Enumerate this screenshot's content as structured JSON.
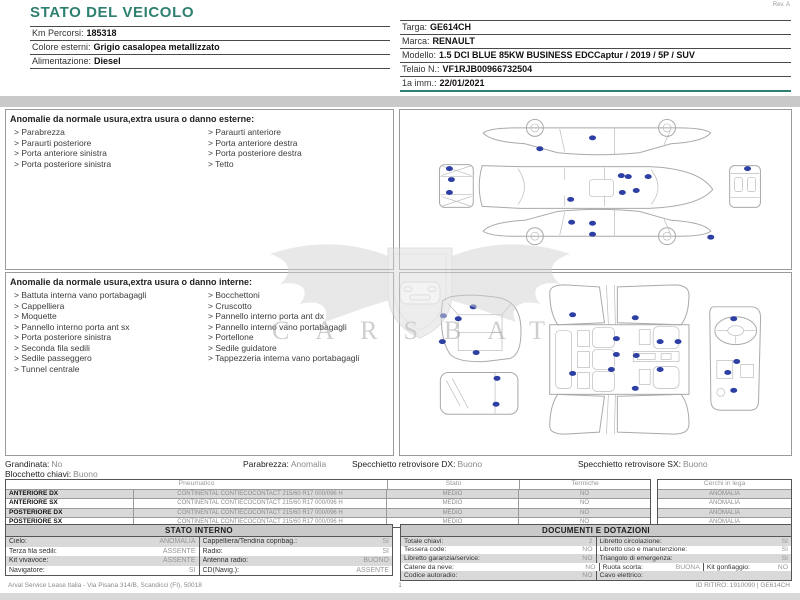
{
  "page": {
    "title": "STATO DEL VEICOLO",
    "rev": "Rev. A"
  },
  "colors": {
    "accent_teal": "#2e8070",
    "dot_blue": "#2e3fa3",
    "band_gray": "#c9c9c9"
  },
  "vehicle_info": {
    "left": [
      {
        "label": "Km Percorsi:",
        "value": "185318"
      },
      {
        "label": "Colore esterni:",
        "value": "Grigio casalopea metallizzato"
      },
      {
        "label": "Alimentazione:",
        "value": "Diesel"
      }
    ],
    "right": [
      {
        "label": "Targa:",
        "value": "GE614CH"
      },
      {
        "label": "Marca:",
        "value": "RENAULT"
      },
      {
        "label": "Modello:",
        "value": "1.5 DCI BLUE 85KW BUSINESS EDCCaptur / 2019 / 5P / SUV"
      },
      {
        "label": "Telaio N.:",
        "value": "VF1RJB00966732504"
      },
      {
        "label": "1a imm.:",
        "value": "22/01/2021"
      }
    ]
  },
  "anomalies_exterior": {
    "title": "Anomalie da normale usura,extra usura o danno esterne:",
    "left": [
      "> Parabrezza",
      "> Paraurti posteriore",
      "> Porta anteriore sinistra",
      "> Porta posteriore sinistra"
    ],
    "right": [
      "> Paraurti anteriore",
      "> Porta anteriore destra",
      "> Porta posteriore destra",
      "> Tetto"
    ]
  },
  "anomalies_interior": {
    "title": "Anomalie da normale usura,extra usura o danno interne:",
    "left": [
      "> Battuta interna vano portabagagli",
      "> Cappelliera",
      "> Moquette",
      "> Pannello interno porta ant sx",
      "> Porta posteriore sinistra",
      "> Seconda fila sedili",
      "> Sedile passeggero",
      "> Tunnel centrale"
    ],
    "right": [
      "> Bocchettoni",
      "> Cruscotto",
      "> Pannello interno porta ant dx",
      "> Pannello interno vano portabagagli",
      "> Portellone",
      "> Sedile guidatore",
      "> Tappezzeria interna vano portabagagli"
    ]
  },
  "condition_summary": {
    "grandinata": {
      "label": "Grandinata:",
      "value": "No"
    },
    "parabrezza": {
      "label": "Parabrezza:",
      "value": "Anomalia"
    },
    "specchietto_dx": {
      "label": "Specchietto retrovisore DX:",
      "value": "Buono"
    },
    "specchietto_sx": {
      "label": "Specchietto retrovisore SX:",
      "value": "Buono"
    },
    "blocchetto": {
      "label": "Blocchetto chiavi:",
      "value": "Buono"
    }
  },
  "tires": {
    "headers": {
      "pneumatico": "Pneumatico",
      "stato": "Stato",
      "termiche": "Termiche",
      "cerchi": "Cerchi in lega"
    },
    "rows": [
      {
        "pos": "ANTERIORE DX",
        "pneumatico": "CONTINENTAL CONTIECOCONTACT 215/60 R17 000/096 H",
        "stato": "MEDIO",
        "termiche": "NO",
        "cerchi": "ANOMALIA"
      },
      {
        "pos": "ANTERIORE SX",
        "pneumatico": "CONTINENTAL CONTIECOCONTACT 215/60 R17 000/096 H",
        "stato": "MEDIO",
        "termiche": "NO",
        "cerchi": "ANOMALIA"
      },
      {
        "pos": "POSTERIORE DX",
        "pneumatico": "CONTINENTAL CONTIECOCONTACT 215/60 R17 000/096 H",
        "stato": "MEDIO",
        "termiche": "NO",
        "cerchi": "ANOMALIA"
      },
      {
        "pos": "POSTERIORE SX",
        "pneumatico": "CONTINENTAL CONTIECOCONTACT 215/60 R17 000/096 H",
        "stato": "MEDIO",
        "termiche": "NO",
        "cerchi": "ANOMALIA"
      }
    ]
  },
  "stato_interno": {
    "title": "STATO INTERNO",
    "rows": [
      {
        "l1": "Cielo:",
        "v1": "ANOMALIA",
        "l2": "Cappelliera/Tendina copribag.:",
        "v2": "SI"
      },
      {
        "l1": "Terza fila sedili:",
        "v1": "ASSENTE",
        "l2": "Radio:",
        "v2": "SI"
      },
      {
        "l1": "Kit vivavoce:",
        "v1": "ASSENTE",
        "l2": "Antenna radio:",
        "v2": "BUONO"
      },
      {
        "l1": "Navigatore:",
        "v1": "SI",
        "l2": "CD(Navig.):",
        "v2": "ASSENTE"
      }
    ]
  },
  "documenti": {
    "title": "DOCUMENTI E DOTAZIONI",
    "rows": [
      {
        "l1": "Totale chiavi:",
        "v1": "2",
        "l2": "Libretto circolazione:",
        "v2": "SI"
      },
      {
        "l1": "Tessera code:",
        "v1": "NO",
        "l2": "Libretto uso e manutenzione:",
        "v2": "SI"
      },
      {
        "l1": "Libretto garanzia/service:",
        "v1": "NO",
        "l2": "Triangolo di emergenza:",
        "v2": "SI"
      },
      {
        "l1": "Catene da neve:",
        "v1": "NO",
        "l2": "Ruota scorta:",
        "v2": "BUONA",
        "l3": "Kit gonfiaggio:",
        "v3": "NO"
      },
      {
        "l1": "Codice autoradio:",
        "v1": "NO",
        "l2": "Cavo elettrico:",
        "v2": ""
      }
    ]
  },
  "watermark": {
    "letters": "CARSBAT"
  },
  "diagrams": {
    "exterior_dots": [
      [
        193,
        28
      ],
      [
        140,
        39
      ],
      [
        222,
        66
      ],
      [
        229,
        67
      ],
      [
        249,
        67
      ],
      [
        237,
        81
      ],
      [
        223,
        83
      ],
      [
        171,
        90
      ],
      [
        49,
        59
      ],
      [
        51,
        70
      ],
      [
        49,
        83
      ],
      [
        349,
        59
      ],
      [
        172,
        113
      ],
      [
        193,
        114
      ],
      [
        193,
        125
      ],
      [
        312,
        128
      ]
    ],
    "interior_dots": [
      [
        73,
        34
      ],
      [
        43,
        43
      ],
      [
        58,
        46
      ],
      [
        42,
        69
      ],
      [
        76,
        80
      ],
      [
        97,
        106
      ],
      [
        96,
        132
      ],
      [
        173,
        42
      ],
      [
        236,
        45
      ],
      [
        217,
        66
      ],
      [
        261,
        69
      ],
      [
        279,
        69
      ],
      [
        217,
        82
      ],
      [
        237,
        83
      ],
      [
        212,
        97
      ],
      [
        261,
        97
      ],
      [
        173,
        101
      ],
      [
        236,
        116
      ],
      [
        335,
        46
      ],
      [
        338,
        89
      ],
      [
        329,
        100
      ],
      [
        335,
        118
      ]
    ]
  },
  "footer": {
    "left": "Arval Service Lease Italia - Via Pisana 314/B, Scandicci (FI), 50018",
    "center": "1",
    "right": "ID RITIRO: 1910090 | GE614CH"
  }
}
